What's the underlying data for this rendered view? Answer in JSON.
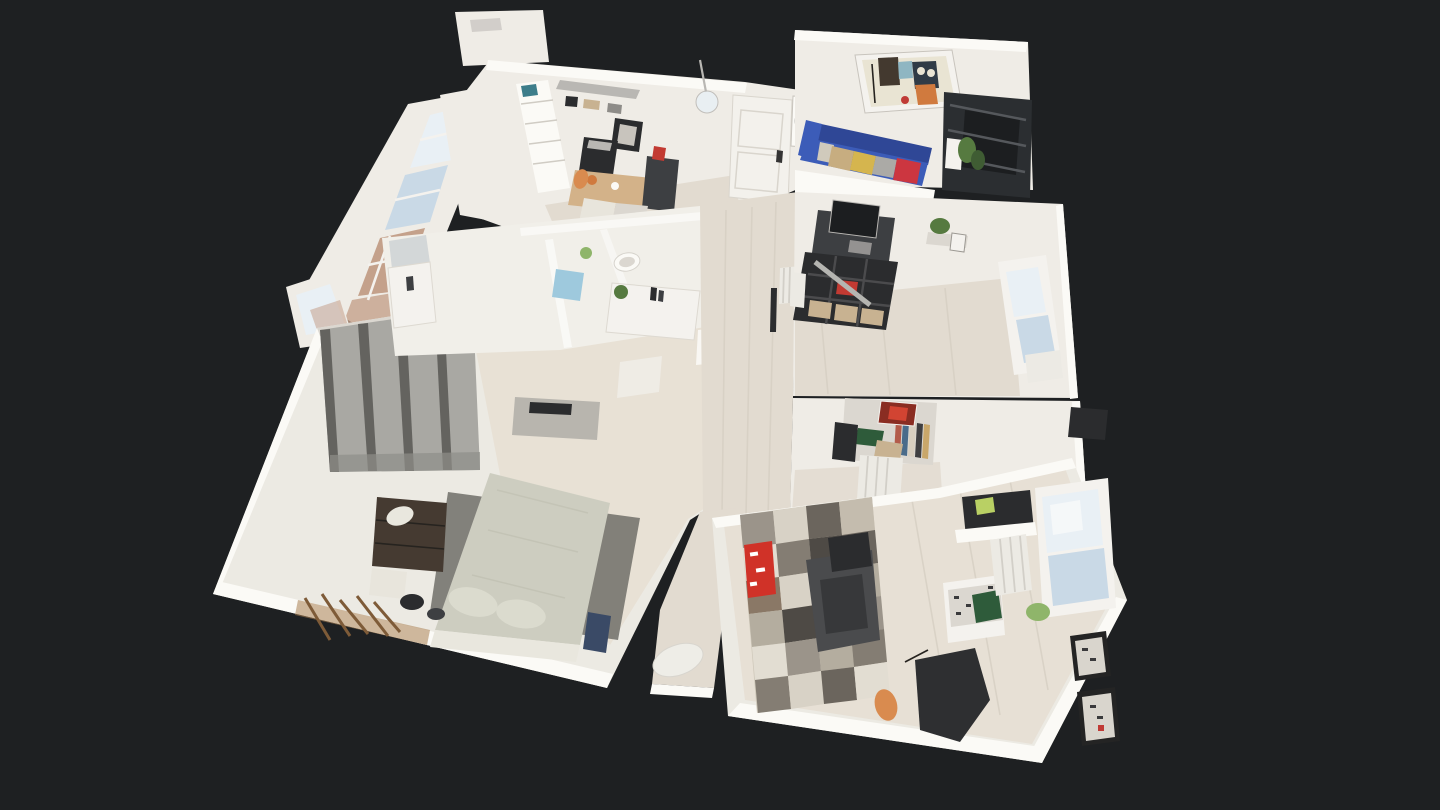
{
  "scene": {
    "viewer_label": "3D dollhouse view of apartment scan",
    "rooms": [
      {
        "name": "kitchen"
      },
      {
        "name": "living-room"
      },
      {
        "name": "home-office"
      },
      {
        "name": "bathroom"
      },
      {
        "name": "hallway"
      },
      {
        "name": "master-bedroom"
      },
      {
        "name": "second-bedroom"
      },
      {
        "name": "hall-nook"
      }
    ]
  },
  "colors": {
    "background": "#1e2022",
    "wallWhite": "#efece6",
    "wallBright": "#fbfaf6",
    "wallShade": "#dbd7d0",
    "wallGray": "#c8c4bd",
    "roomPale": "#eceae3",
    "floorWood": "#e2dbd0",
    "floorWarm": "#e8e1d5",
    "floorBedroom": "#e7e0d5",
    "marble": "#f1efe9",
    "glassSky": "#e9f0f5",
    "glassBlue": "#c9d9e6",
    "glassWhite": "#f6f8f9",
    "brick": "#c4a18b",
    "frameWhite": "#f4f2ee",
    "doorWhite": "#f3f1ec",
    "handleDark": "#343434",
    "woodTable": "#d3b289",
    "blackish": "#2b2c2e",
    "darkGray": "#3d3f42",
    "charcoal": "#4a4b4d",
    "charcoalDark": "#37383a",
    "midGray": "#8e8c88",
    "silver": "#b9b7b3",
    "consoleGray": "#b8b5ae",
    "sofaBlue": "#3c5cb8",
    "sofaBlueDark": "#2f4796",
    "pillowBeige": "#c7ad80",
    "pillowYellow": "#d5b54e",
    "pillowGray": "#abaaa6",
    "pillowRed": "#cc3640",
    "pillowWhite": "#d0cabc",
    "paintCream": "#e9e4d3",
    "paintTeal": "#8fb6c2",
    "paintOrange": "#d07a3e",
    "paintBrown": "#43392f",
    "paintNavy": "#303b46",
    "paintRed": "#c03a35",
    "plantGreen": "#567a40",
    "plantDark": "#3f5c33",
    "plantLight": "#8fb56a",
    "basketTan": "#c8b291",
    "boxRed": "#c23a32",
    "teal": "#3d7d8a",
    "orange": "#d98b4f",
    "bedSage": "#cdcdc0",
    "bedSageLight": "#dbdbce",
    "bedFrameWhite": "#e9e7de",
    "rugGray": "#77766f",
    "curtainBase": "#a9a8a3",
    "curtainDark": "#64635f",
    "curtainShade": "#8f8e89",
    "dresserBrown": "#453a31",
    "rackWood": "#aa8052",
    "bagBlue": "#3a4a66",
    "redBag": "#d03228",
    "jacketBlack": "#2e2f31",
    "greenBag": "#2e5b3a",
    "lime": "#b9d064",
    "radiator": "#eceae4",
    "frameBlack": "#242424",
    "frameInner": "#d9d5cd",
    "towelBlue": "#9ec9dd",
    "mirrorGray": "#cfd4d6",
    "tvDark": "#2b2e31",
    "tvScreen": "#1c1e20",
    "chairWhite": "#e8e5dc",
    "binWhite": "#eeede7",
    "quiltBase": "#cfc8ba",
    "quilt": [
      "#9b948a",
      "#d8d2c6",
      "#6b655d",
      "#c4bcae",
      "#e2ddd2",
      "#847d73",
      "#8a7866",
      "#b4ad9f",
      "#4e4a45"
    ]
  }
}
